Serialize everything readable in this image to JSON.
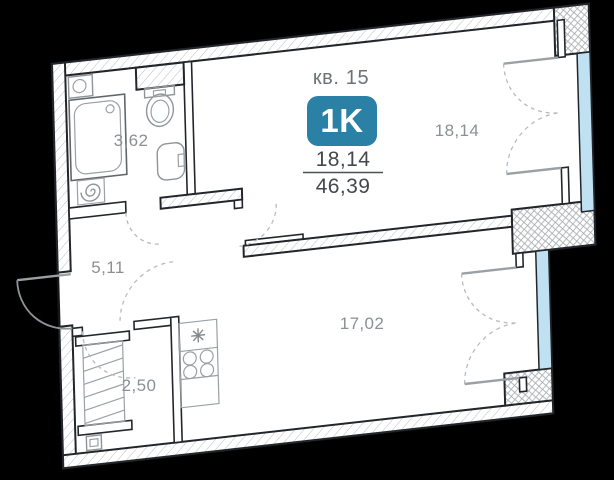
{
  "header": {
    "apartment_label": "кв. 15",
    "type_badge": "1K",
    "area_living": "18,14",
    "area_total": "46,39"
  },
  "rooms": {
    "bathroom": {
      "area": "3,62"
    },
    "hallway": {
      "area": "5,11"
    },
    "wardrobe": {
      "area": "2,50"
    },
    "kitchen_living": {
      "area": "17,02"
    },
    "living_room": {
      "area": "18,14"
    }
  },
  "icons": {
    "sink_icon": "asterisk-sink-symbol",
    "stove_icon": "four-burner-stove",
    "washer_icon": "spiral-drum"
  },
  "colors": {
    "background": "#000000",
    "badge_bg": "#2b80a6",
    "badge_text": "#ffffff",
    "window_glass": "#bfe1f1",
    "wall_outline": "#22262a",
    "hatch_line": "#b6babd",
    "header_gray": "#6c7276",
    "area_dark": "#43484c",
    "room_label_gray": "#8b9094"
  }
}
